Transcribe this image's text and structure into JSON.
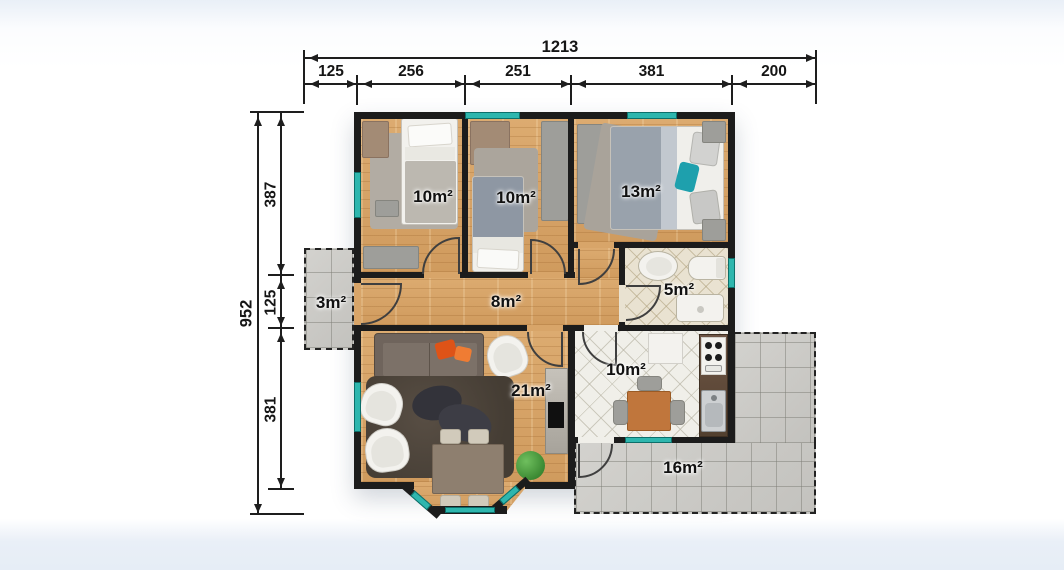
{
  "floor_plan": {
    "rooms": [
      {
        "id": "bedroom-1",
        "area": "10m²"
      },
      {
        "id": "bedroom-2",
        "area": "10m²"
      },
      {
        "id": "bedroom-3",
        "area": "13m²"
      },
      {
        "id": "porch",
        "area": "3m²"
      },
      {
        "id": "hallway",
        "area": "8m²"
      },
      {
        "id": "bathroom",
        "area": "5m²"
      },
      {
        "id": "living-room",
        "area": "21m²"
      },
      {
        "id": "kitchen",
        "area": "10m²"
      },
      {
        "id": "terrace",
        "area": "16m²"
      }
    ],
    "dimensions_top": {
      "total": "1213",
      "segments": [
        "125",
        "256",
        "251",
        "381",
        "200"
      ]
    },
    "dimensions_left": {
      "total": "952",
      "segments": [
        "387",
        "125",
        "381"
      ]
    },
    "colors": {
      "wall": "#1c1c1c",
      "window_glass": "#2eb6ae",
      "wood_floor": "#d8a569",
      "accent_pillow_orange": "#de5317",
      "accent_pillow_teal": "#1ea0ad"
    }
  }
}
